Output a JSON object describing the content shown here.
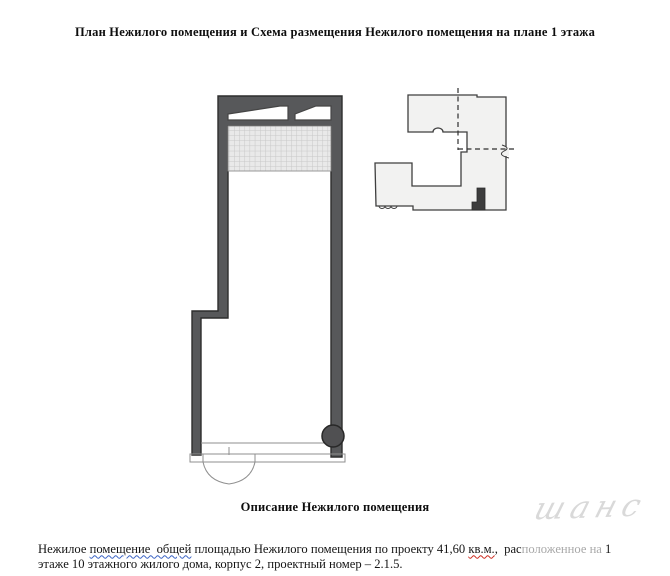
{
  "page": {
    "title": "План Нежилого помещения и Схема размещения Нежилого помещения на плане 1 этажа",
    "section_heading": "Описание Нежилого помещения",
    "watermark_text": "шанс"
  },
  "description": {
    "line1": {
      "part1": "Нежилое ",
      "underlined_blue": "помещение  общей",
      "part2": " площадью Нежилого помещения по проекту 41,60 ",
      "underlined_red": "кв.м.",
      "part3": ",  рас",
      "faded_by_watermark": "положенное на",
      "part4": " 1"
    },
    "line2": "этаже 10 этажного жилого дома, корпус 2, проектный номер – 2.1.5."
  },
  "drawing_labels": {
    "floor_plan": "план нежилого помещения",
    "location_scheme": "схема размещения на плане 1 этажа"
  },
  "colors": {
    "wall_fill": "#57585a",
    "wall_outline": "#2d2d2d",
    "window_fill": "#ffffff",
    "grid_bg": "#e9e9e9",
    "grid_line": "#c7c7c7",
    "thin_line": "#8f8f8f",
    "column_fill": "#505052",
    "scheme_fill": "#f2f2f1",
    "scheme_outline": "#3f3f3f",
    "premises_marker": "#3d3d3d",
    "dashed_axis": "#2f2f2f",
    "underline_blue": "#3b63c4",
    "underline_red": "#cc2a1e",
    "watermark": "#d9d9d9"
  }
}
